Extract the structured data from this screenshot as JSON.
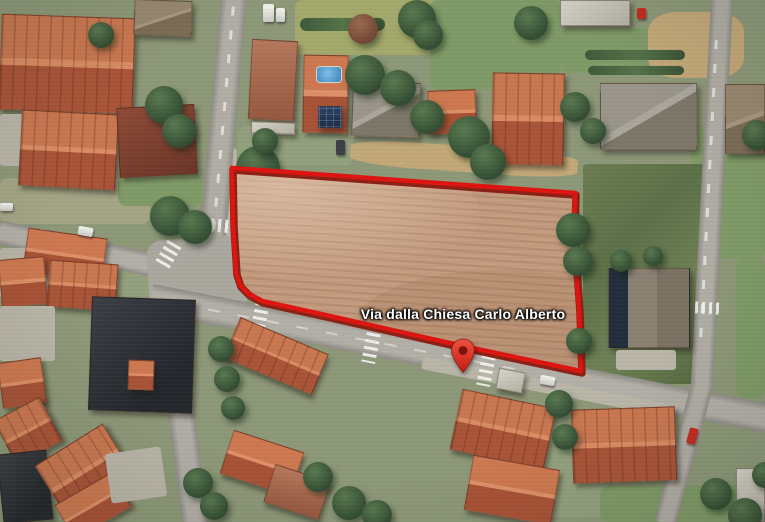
{
  "map": {
    "road_label": "Via dalla Chiesa Carlo Alberto",
    "marker": {
      "icon": "location-pin-icon",
      "color": "#d8352a"
    },
    "parcel": {
      "outline_color": "#de1410",
      "outline_shadow_color": "#8c2014",
      "fill_color": "#c49b7e",
      "points": "232,168 575,193 574,230 576,268 579,310 581,371 463,346 330,316 262,301 249,294 240,285 236,273 233,225"
    }
  }
}
